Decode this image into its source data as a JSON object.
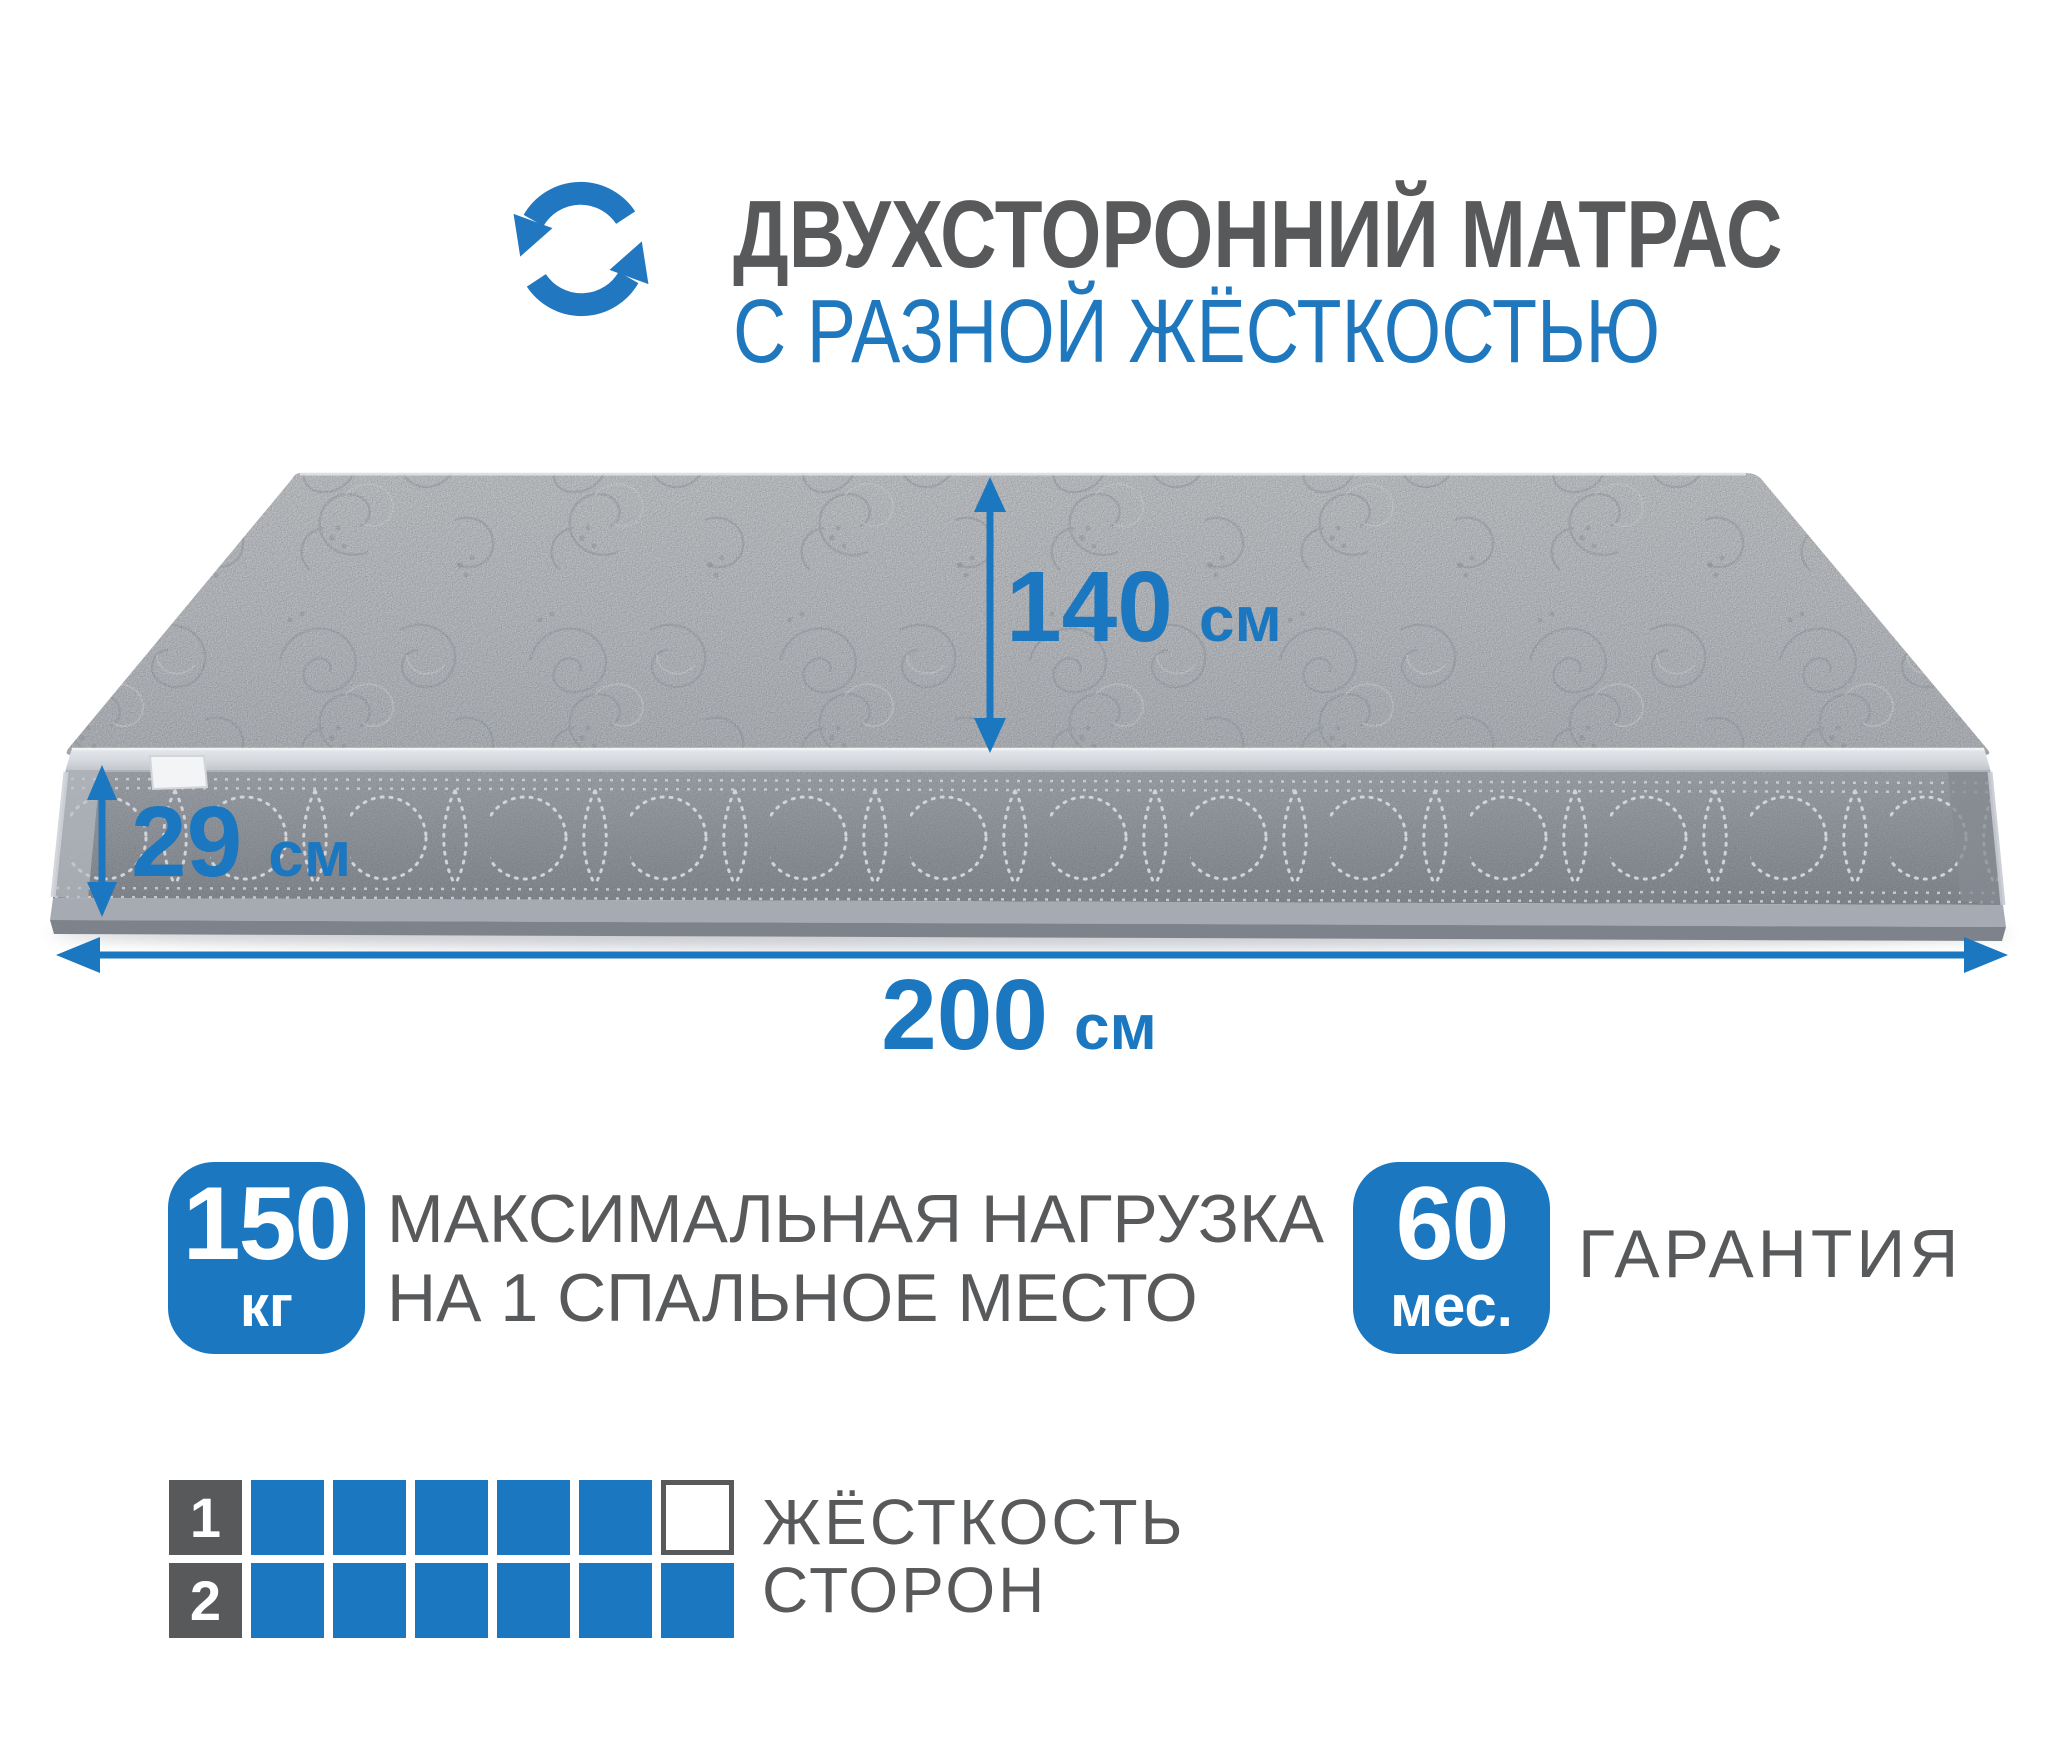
{
  "header": {
    "icon": "rotate-arrows-icon",
    "title": "ДВУХСТОРОННИЙ МАТРАС",
    "subtitle": "С РАЗНОЙ ЖЁСТКОСТЬЮ"
  },
  "dimensions": {
    "depth": {
      "value": "140",
      "unit": "см"
    },
    "height": {
      "value": "29",
      "unit": "см"
    },
    "length": {
      "value": "200",
      "unit": "см"
    }
  },
  "features": {
    "max_load": {
      "value": "150",
      "unit": "кг",
      "label_line1": "МАКСИМАЛЬНАЯ НАГРУЗКА",
      "label_line2": "НА 1 СПАЛЬНОЕ МЕСТО"
    },
    "warranty": {
      "value": "60",
      "unit": "мес.",
      "label": "ГАРАНТИЯ"
    }
  },
  "hardness": {
    "label_line1": "ЖЁСТКОСТЬ",
    "label_line2": "СТОРОН",
    "scale_total": 6,
    "rows": [
      {
        "side": "1",
        "filled": 5
      },
      {
        "side": "2",
        "filled": 6
      }
    ]
  },
  "colors": {
    "accent": "#1b77bf",
    "text_dark": "#58595b"
  }
}
